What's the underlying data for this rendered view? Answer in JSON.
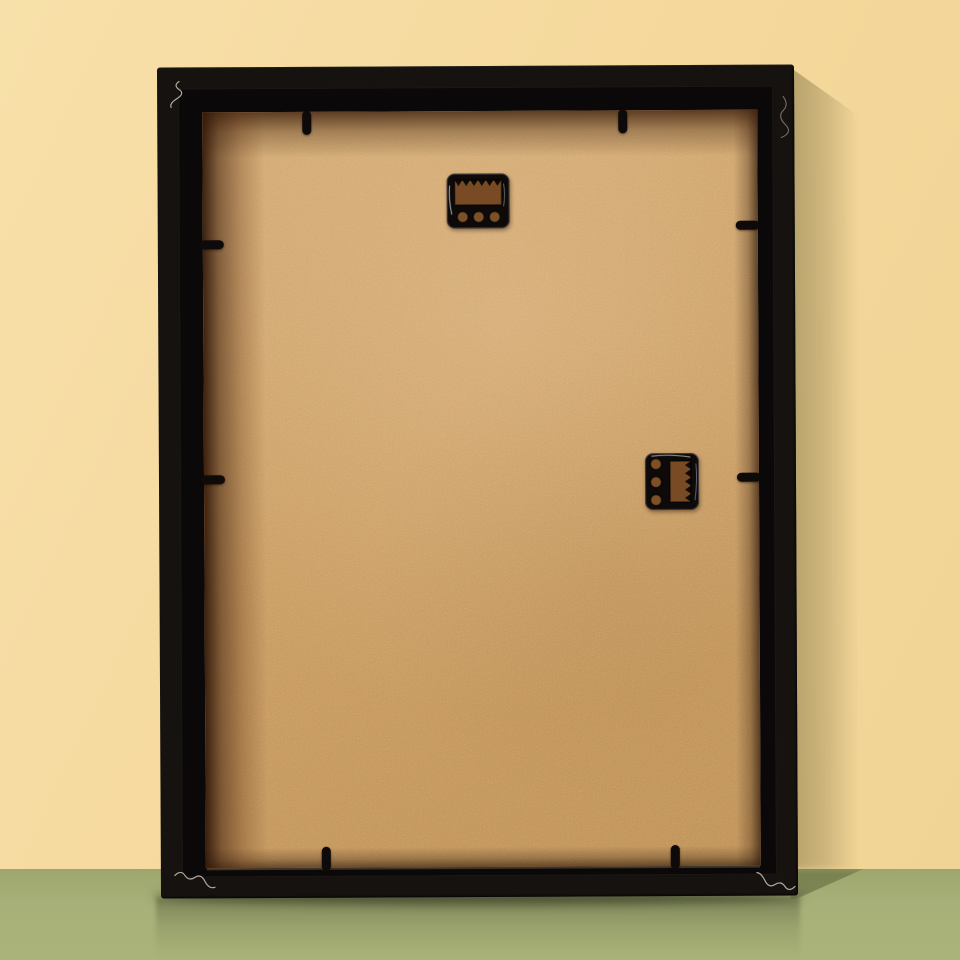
{
  "scene": {
    "type": "product-photo",
    "subject": "Back view of an empty black picture frame leaning against a pale yellow wall on a green floor",
    "objects": {
      "frame": {
        "label": "picture-frame-back",
        "finish": "matte black wood moulding",
        "backing_material": "MDF hardboard",
        "orientation": "portrait, leaning against wall"
      },
      "hangers": [
        {
          "label": "sawtooth-hanger-top",
          "orientation": "horizontal",
          "position": "top-center",
          "screw_holes": 3,
          "teeth": 6,
          "finish": "glossy black metal"
        },
        {
          "label": "sawtooth-hanger-right",
          "orientation": "vertical",
          "position": "middle-right",
          "screw_holes": 3,
          "teeth": 5,
          "finish": "glossy black metal"
        }
      ],
      "flexi_tabs": {
        "count": 8,
        "layout": "2 per side holding backing board"
      },
      "corner_scratches": {
        "count": 4,
        "description": "small silver squiggle scuffs at frame corners"
      },
      "shadows": [
        "soft vertical shadow on wall right of frame",
        "wedge shadow on floor at lower right",
        "contact shadow and faint reflection on glossy floor"
      ]
    },
    "colors": {
      "wall": "#f5d99d",
      "wall_light": "#f8e0aa",
      "wall_dim": "#f0d495",
      "floor": "#a7b078",
      "floor_dark": "#9ca66d",
      "floor_bright": "#aab47a",
      "frame_black": "#16120f",
      "frame_step": "#0a0808",
      "backing": "#c8985f",
      "backing_light": "#d0a46c",
      "backing_dim": "#bd8d56",
      "backing_edge_shadow": "#3f1f0c",
      "metal": "#0d0a09",
      "slot": "#784b24",
      "hole": "#7d5128",
      "scratch": "#d9d2c6"
    }
  }
}
